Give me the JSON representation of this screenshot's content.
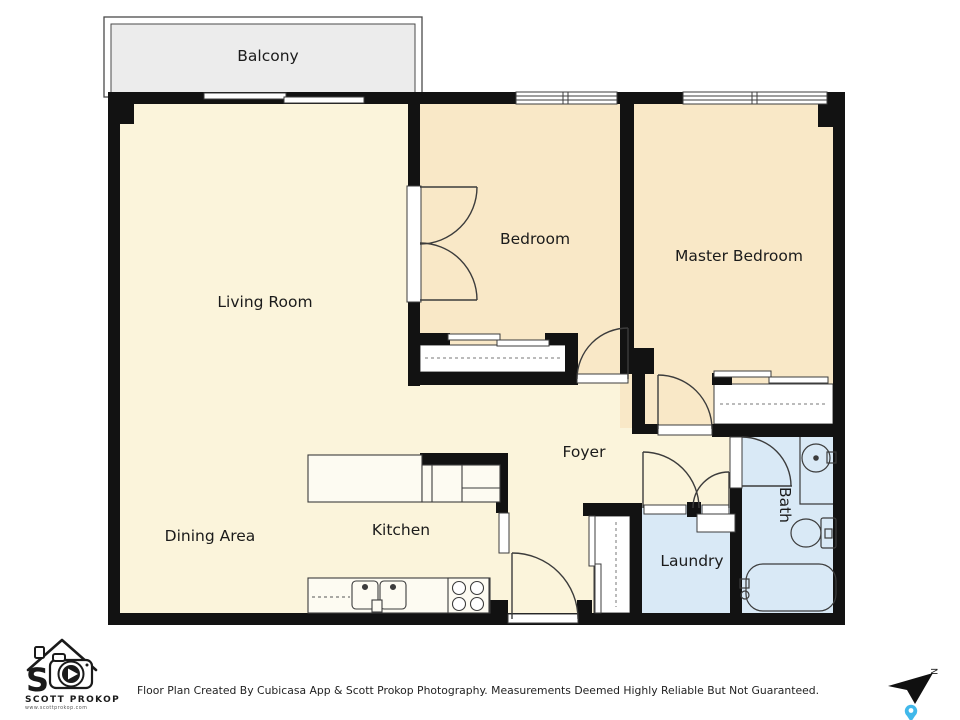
{
  "floor_plan": {
    "rooms": [
      {
        "name": "balcony",
        "label": "Balcony",
        "fill": "#ececec"
      },
      {
        "name": "living-room",
        "label": "Living Room",
        "fill": "#fbf4db"
      },
      {
        "name": "bedroom",
        "label": "Bedroom",
        "fill": "#f9e8c7"
      },
      {
        "name": "master-bedroom",
        "label": "Master Bedroom",
        "fill": "#f9e8c7"
      },
      {
        "name": "foyer",
        "label": "Foyer",
        "fill": "#fbf4db"
      },
      {
        "name": "dining-area",
        "label": "Dining Area",
        "fill": "#fbf4db"
      },
      {
        "name": "kitchen",
        "label": "Kitchen",
        "fill": "#fbf4db"
      },
      {
        "name": "laundry",
        "label": "Laundry",
        "fill": "#d9e9f6"
      },
      {
        "name": "bath",
        "label": "Bath",
        "fill": "#d9e9f6"
      }
    ],
    "colors": {
      "wall": "#121212",
      "fixture_line": "#3c3c3c",
      "balcony_fill": "#ececec",
      "cream_fill": "#fbf4db",
      "peach_fill": "#f9e8c7",
      "blue_fill": "#d9e9f6",
      "label_text": "#1b1b1b"
    }
  },
  "compass": {
    "north_label": "N",
    "arrow_color": "#101010",
    "pin_color": "#41b8ea"
  },
  "branding": {
    "monogram": "S",
    "name": "SCOTT PROKOP",
    "website": "www.scottprokop.com"
  },
  "footer": {
    "disclaimer": "Floor Plan Created By Cubicasa App & Scott Prokop Photography. Measurements Deemed Highly Reliable But Not Guaranteed."
  }
}
